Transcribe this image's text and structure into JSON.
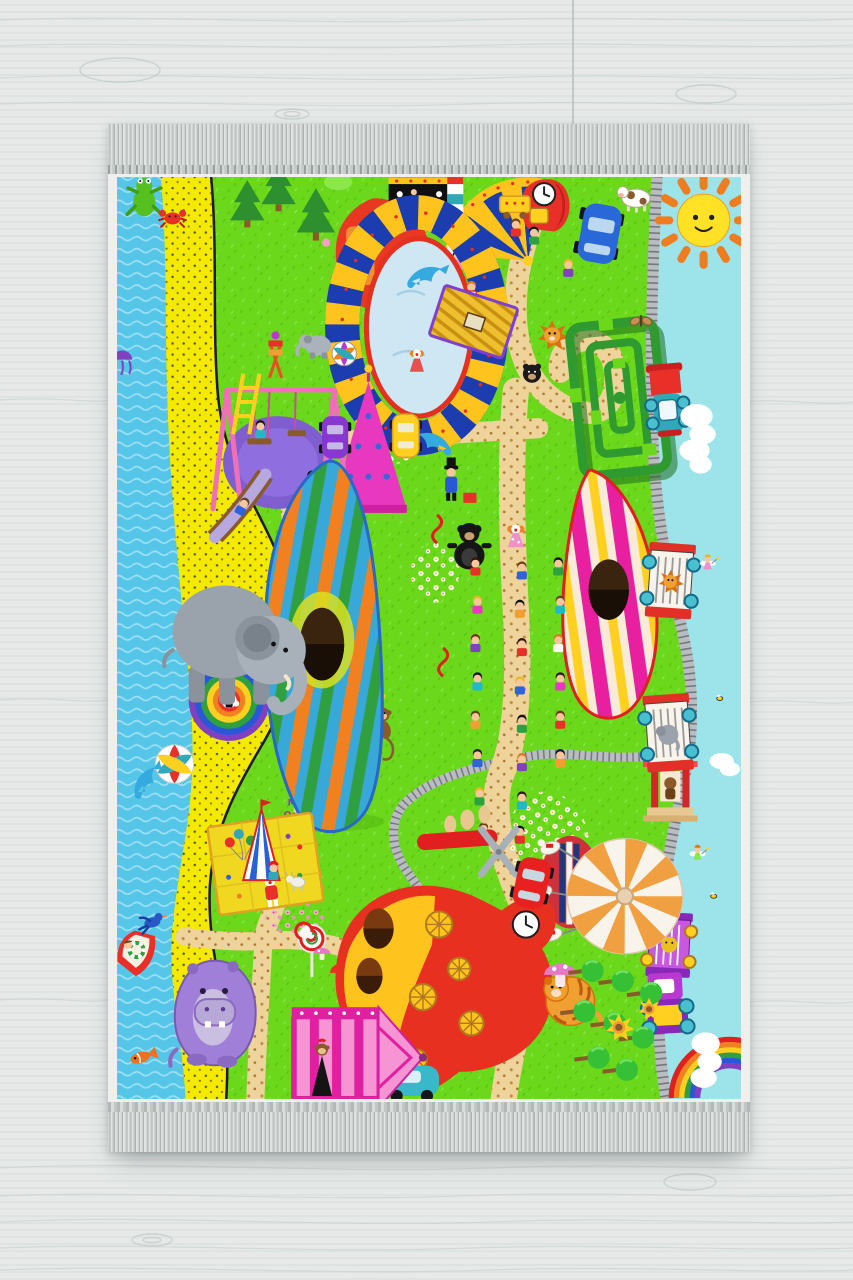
{
  "scene": {
    "subject": "children-circus-amusement-park-play-rug-on-wood-floor",
    "alphabet": [
      "A",
      "B",
      "C",
      "D",
      "E",
      "F",
      "G",
      "H",
      "I",
      "K",
      "M",
      "O"
    ],
    "palette": {
      "floor_wood": "#e4e8e7",
      "wood_grain": "#c6cecd",
      "fringe": "#c9cecd",
      "selvage": "#eff0ee",
      "grass": "#6cd81c",
      "water": "#55c6e8",
      "sand": "#f4ea00",
      "sky_strip": "#9ce4e9",
      "path": "#eed49a",
      "track": "#b9bdc1",
      "sun_core": "#ffe226",
      "sun_ray": "#ef7d1f",
      "pool": "#cfe7f3",
      "pool_rim": "#e23120",
      "ring_blue": "#1c3db0",
      "ring_yellow": "#ffc31e",
      "dolphin": "#35aade",
      "maze_green": "#2f9a2f",
      "carousel_orange": "#f0a040",
      "playhouse_red": "#e83020",
      "playhouse_yellow": "#ffc31e",
      "pink_tent": "#f794d4",
      "hippo_purple": "#9f7fd8",
      "elephant_gray": "#9aa2ac",
      "cloud": "#ffffff"
    }
  }
}
